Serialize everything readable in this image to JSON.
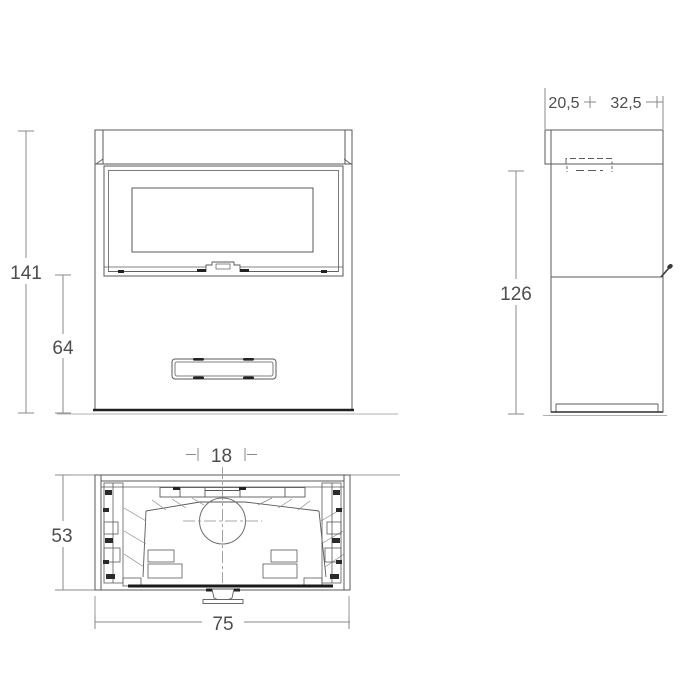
{
  "drawing": {
    "colors": {
      "background": "#ffffff",
      "line": "#5a5a5a",
      "dark_line": "#1e1e1e",
      "dim_line": "#8a8a8a",
      "text": "#4d4d4d"
    },
    "front_view": {
      "height_total": "141",
      "height_base": "64"
    },
    "side_view": {
      "depth_front": "20,5",
      "depth_rear": "32,5",
      "height": "126"
    },
    "plan_view": {
      "flue_diameter": "18",
      "depth": "53",
      "width": "75"
    }
  }
}
